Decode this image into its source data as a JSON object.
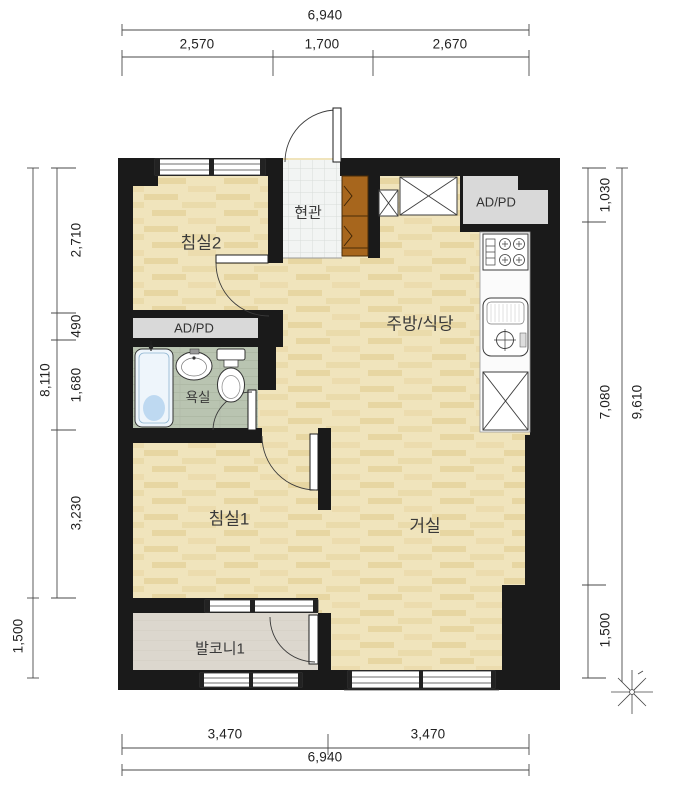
{
  "plan": {
    "rooms": {
      "bedroom2": "침실2",
      "entrance": "현관",
      "kitchen_dining": "주방/식당",
      "ad_pd_top": "AD/PD",
      "ad_pd_left": "AD/PD",
      "bathroom": "욕실",
      "bedroom1": "침실1",
      "living": "거실",
      "balcony1": "발코니1"
    },
    "dimensions": {
      "top": {
        "total": "6,940",
        "segments": [
          "2,570",
          "1,700",
          "2,670"
        ]
      },
      "bottom": {
        "total": "6,940",
        "segments": [
          "3,470",
          "3,470"
        ]
      },
      "left": {
        "total": "8,110",
        "segments": [
          "2,710",
          "490",
          "1,680",
          "3,230"
        ],
        "balcony_depth": "1,500"
      },
      "right": {
        "total": "9,610",
        "segments": [
          "1,030",
          "7,080",
          "1,500"
        ]
      }
    },
    "colors": {
      "wall": "#1a1a1a",
      "wood": "#f0e4bc",
      "woodPlank": "#e7d6a2",
      "entranceTile": "#f2f4f3",
      "entranceTileLine": "#d8dcda",
      "bathFloor": "#b9c4b1",
      "bathFloorLine": "#a5b19c",
      "balconyFloor": "#dcd7ce",
      "cabinet": "#a7661d",
      "adpdBox": "#d9d9d9",
      "tubWater": "#aacdec",
      "counter": "#fbfbfb"
    }
  }
}
